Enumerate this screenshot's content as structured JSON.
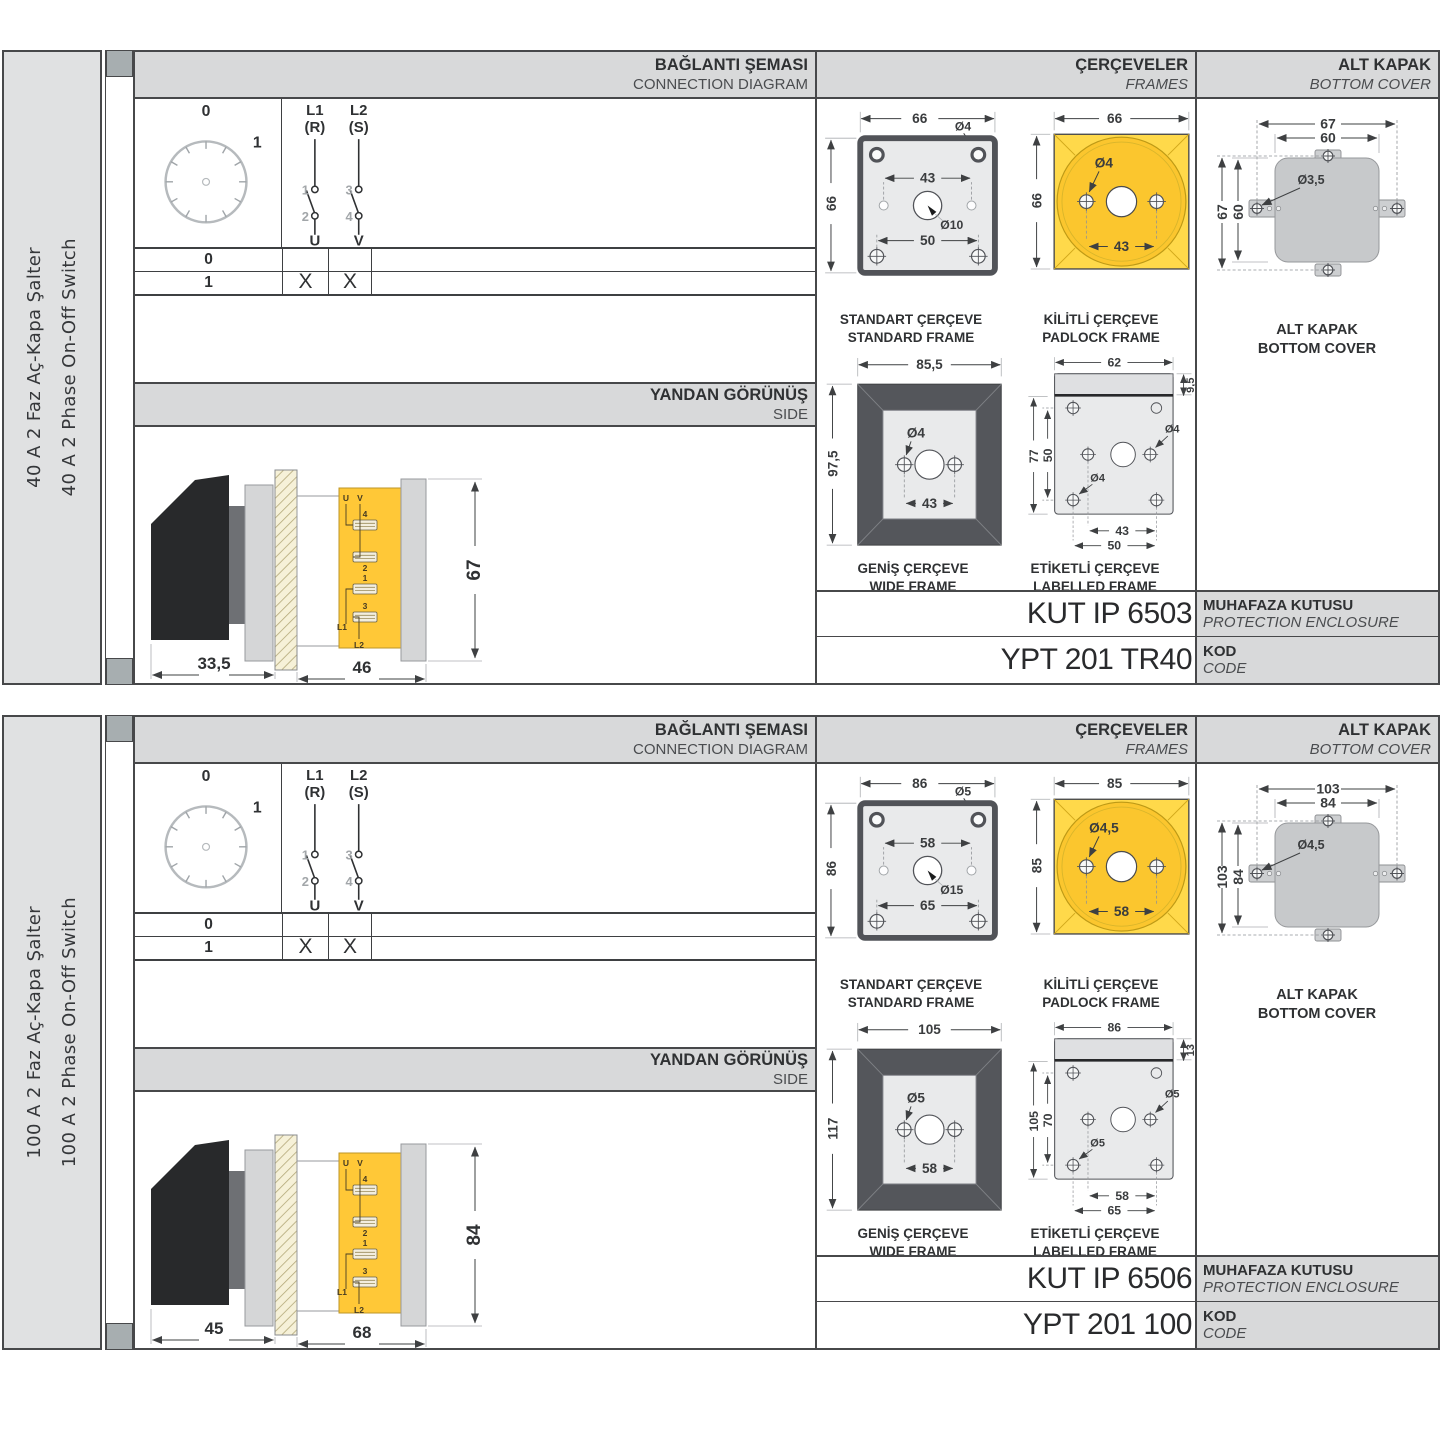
{
  "panels": [
    {
      "sidebar": {
        "title_tr": "40 A 2 Faz Aç-Kapa Şalter",
        "title_en": "40 A 2 Phase On-Off Switch"
      },
      "headers": {
        "connection": {
          "tr": "BAĞLANTI ŞEMASI",
          "en": "CONNECTION DIAGRAM"
        },
        "frames": {
          "tr": "ÇERÇEVELER",
          "en": "FRAMES"
        },
        "cover": {
          "tr": "ALT KAPAK",
          "en": "BOTTOM COVER"
        },
        "side": {
          "tr": "YANDAN GÖRÜNÜŞ",
          "en": "SIDE"
        }
      },
      "connection": {
        "dial": {
          "pos0": "0",
          "pos1": "1"
        },
        "poles": [
          {
            "line": "L1",
            "phase": "(R)",
            "c_top": "1",
            "c_bottom": "2",
            "out": "U"
          },
          {
            "line": "L2",
            "phase": "(S)",
            "c_top": "3",
            "c_bottom": "4",
            "out": "V"
          }
        ],
        "table": {
          "rows": [
            {
              "label": "0",
              "u": "",
              "v": ""
            },
            {
              "label": "1",
              "u": "X",
              "v": "X"
            }
          ]
        }
      },
      "side_view": {
        "dim_front": "33,5",
        "dim_body": "46",
        "dim_height": "67",
        "t_u": "U",
        "t_v": "V",
        "t_4": "4",
        "t_2": "2",
        "t_1": "1",
        "t_3": "3",
        "t_l1": "L1",
        "t_l2": "L2"
      },
      "frames": {
        "standard": {
          "title_tr": "STANDART ÇERÇEVE",
          "title_en": "STANDARD FRAME",
          "w": "66",
          "h": "66",
          "holes": "43",
          "screws": "50",
          "hole_dia": "Ø4",
          "center_dia": "Ø10"
        },
        "padlock": {
          "title_tr": "KİLİTLİ ÇERÇEVE",
          "title_en": "PADLOCK FRAME",
          "w": "66",
          "h": "66",
          "holes": "43",
          "hole_dia": "Ø4"
        },
        "wide": {
          "title_tr": "GENİŞ ÇERÇEVE",
          "title_en": "WIDE FRAME",
          "w": "85,5",
          "h": "97,5",
          "holes": "43",
          "hole_dia": "Ø4"
        },
        "labelled": {
          "title_tr": "ETİKETLİ ÇERÇEVE",
          "title_en": "LABELLED FRAME",
          "w": "62",
          "strip": "9,5",
          "h": "77",
          "holes_v": "50",
          "holes_h": "43",
          "screws": "50",
          "hole_dia_mid": "Ø4",
          "hole_dia_low": "Ø4"
        }
      },
      "cover": {
        "title_tr": "ALT KAPAK",
        "title_en": "BOTTOM COVER",
        "outer_w": "67",
        "inner_w": "60",
        "outer_h": "67",
        "inner_h": "60",
        "hole_dia": "Ø3,5"
      },
      "enclosure": {
        "value": "KUT IP 6503",
        "label_tr": "MUHAFAZA KUTUSU",
        "label_en": "PROTECTION ENCLOSURE"
      },
      "code": {
        "value": "YPT 201 TR40",
        "label_tr": "KOD",
        "label_en": "CODE"
      }
    },
    {
      "sidebar": {
        "title_tr": "100 A 2 Faz Aç-Kapa Şalter",
        "title_en": "100 A 2 Phase On-Off Switch"
      },
      "headers": {
        "connection": {
          "tr": "BAĞLANTI ŞEMASI",
          "en": "CONNECTION DIAGRAM"
        },
        "frames": {
          "tr": "ÇERÇEVELER",
          "en": "FRAMES"
        },
        "cover": {
          "tr": "ALT KAPAK",
          "en": "BOTTOM COVER"
        },
        "side": {
          "tr": "YANDAN GÖRÜNÜŞ",
          "en": "SIDE"
        }
      },
      "connection": {
        "dial": {
          "pos0": "0",
          "pos1": "1"
        },
        "poles": [
          {
            "line": "L1",
            "phase": "(R)",
            "c_top": "1",
            "c_bottom": "2",
            "out": "U"
          },
          {
            "line": "L2",
            "phase": "(S)",
            "c_top": "3",
            "c_bottom": "4",
            "out": "V"
          }
        ],
        "table": {
          "rows": [
            {
              "label": "0",
              "u": "",
              "v": ""
            },
            {
              "label": "1",
              "u": "X",
              "v": "X"
            }
          ]
        }
      },
      "side_view": {
        "dim_front": "45",
        "dim_body": "68",
        "dim_height": "84",
        "t_u": "U",
        "t_v": "V",
        "t_4": "4",
        "t_2": "2",
        "t_1": "1",
        "t_3": "3",
        "t_l1": "L1",
        "t_l2": "L2"
      },
      "frames": {
        "standard": {
          "title_tr": "STANDART ÇERÇEVE",
          "title_en": "STANDARD FRAME",
          "w": "86",
          "h": "86",
          "holes": "58",
          "screws": "65",
          "hole_dia": "Ø5",
          "center_dia": "Ø15"
        },
        "padlock": {
          "title_tr": "KİLİTLİ ÇERÇEVE",
          "title_en": "PADLOCK FRAME",
          "w": "85",
          "h": "85",
          "holes": "58",
          "hole_dia": "Ø4,5"
        },
        "wide": {
          "title_tr": "GENİŞ ÇERÇEVE",
          "title_en": "WIDE FRAME",
          "w": "105",
          "h": "117",
          "holes": "58",
          "hole_dia": "Ø5"
        },
        "labelled": {
          "title_tr": "ETİKETLİ ÇERÇEVE",
          "title_en": "LABELLED FRAME",
          "w": "86",
          "strip": "13",
          "h": "105",
          "holes_v": "70",
          "holes_h": "58",
          "screws": "65",
          "hole_dia_mid": "Ø5",
          "hole_dia_low": "Ø5"
        }
      },
      "cover": {
        "title_tr": "ALT KAPAK",
        "title_en": "BOTTOM COVER",
        "outer_w": "103",
        "inner_w": "84",
        "outer_h": "103",
        "inner_h": "84",
        "hole_dia": "Ø4,5"
      },
      "enclosure": {
        "value": "KUT IP 6506",
        "label_tr": "MUHAFAZA KUTUSU",
        "label_en": "PROTECTION ENCLOSURE"
      },
      "code": {
        "value": "YPT 201 100",
        "label_tr": "KOD",
        "label_en": "CODE"
      }
    }
  ],
  "colors": {
    "accent_yellow": "#FFD94A",
    "accent_yellow_dark": "#FBC62E",
    "body_yellow": "#FFC837",
    "panel_gray": "#D8D9DA",
    "frame_gray": "#54565B",
    "line": "#3E4042"
  }
}
